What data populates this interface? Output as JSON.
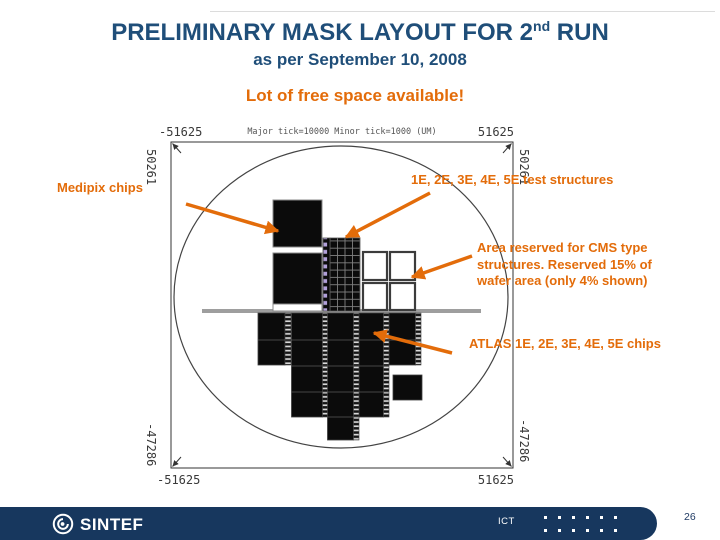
{
  "slide": {
    "title_main": "PRELIMINARY MASK LAYOUT FOR 2",
    "title_sup": "nd",
    "title_tail": " RUN",
    "subtitle": "as per September 10, 2008",
    "highlight": "Lot of free space available!"
  },
  "diagram": {
    "axis": {
      "tick_info": "Major tick=10000 Minor tick=1000 (UM)",
      "top_left": "-51625",
      "top_right": "51625",
      "bottom_left": "-51625",
      "bottom_right": "51625",
      "left_top": "50261",
      "left_bottom": "-47286",
      "right_top": "50261",
      "right_bottom": "-47286"
    },
    "labels": {
      "medipix": "Medipix chips",
      "test_structures": "1E, 2E, 3E, 4E, 5E test structures",
      "cms": "Area reserved for CMS type structures. Reserved 15% of wafer area (only 4% shown)",
      "atlas": "ATLAS 1E, 2E, 3E, 4E, 5E chips"
    }
  },
  "footer": {
    "brand": "SINTEF",
    "dept": "ICT",
    "page": "26"
  },
  "colors": {
    "title_navy": "#1F4E79",
    "accent_orange": "#E36C0A",
    "footer_navy": "#17375E"
  }
}
